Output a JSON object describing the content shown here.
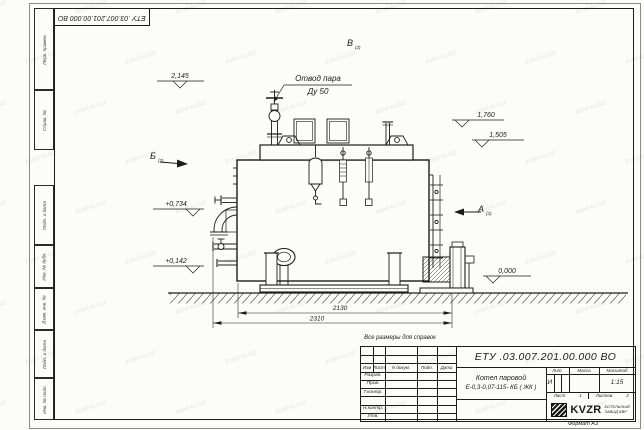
{
  "sheet": {
    "format_note": "Формат А3",
    "reference_note": "Все размеры для справок"
  },
  "watermark": {
    "text": "kotel-kv.biz"
  },
  "frame": {
    "top_stamp_number": "ЕТУ .03.007.201.00.000  ВО",
    "left_stamps": [
      {
        "label": "Перв. примен."
      },
      {
        "label": "Справ. №"
      },
      {
        "label": "Подп. и дата"
      },
      {
        "label": "Инв. № дубл."
      },
      {
        "label": "Взам. инв. №"
      },
      {
        "label": "Подп. и дата"
      },
      {
        "label": "Инв. № подл."
      }
    ]
  },
  "drawing": {
    "callout": {
      "line1": "Отвод пара",
      "line2": "Ду 50"
    },
    "views": {
      "top": {
        "letter": "В",
        "sub": "(2)"
      },
      "left": {
        "letter": "Б",
        "sub": "(2)"
      },
      "right": {
        "letter": "А",
        "sub": "(2)"
      }
    },
    "levels": {
      "l2145": "2,145",
      "l1760": "1,760",
      "l1505": "1,505",
      "l0734": "+0,734",
      "l0142": "+0,142",
      "l0000": "0,000"
    },
    "dimensions": {
      "inner": "2130",
      "outer": "2310"
    }
  },
  "title_block": {
    "doc_number": "ЕТУ .03.007.201.00.000  ВО",
    "product": {
      "line1": "Котел паровой",
      "line2": "Е-0,3-0,07-115- КБ ( ЖК )"
    },
    "columns": {
      "izm": "Изм",
      "list": "Лист",
      "doc": "N докум.",
      "sign": "Подп.",
      "date": "Дата"
    },
    "rows": {
      "developed": "Разраб.",
      "checked": "Пров.",
      "tcontrol": "Т.контр.",
      "ncontrol": "Н.контр.",
      "approved": "Утв."
    },
    "lit": {
      "label": "Лит.",
      "value": "И"
    },
    "mass": {
      "label": "Масса",
      "value": ""
    },
    "scale": {
      "label": "Масштаб",
      "value": "1:15"
    },
    "sheet_no": {
      "label": "Лист",
      "value": "1"
    },
    "sheets_total": {
      "label": "Листов",
      "value": "2"
    },
    "company": {
      "logo": "KVZR",
      "caption1": "КОТЕЛЬНЫЙ",
      "caption2": "ЗАВОД КВР"
    }
  }
}
